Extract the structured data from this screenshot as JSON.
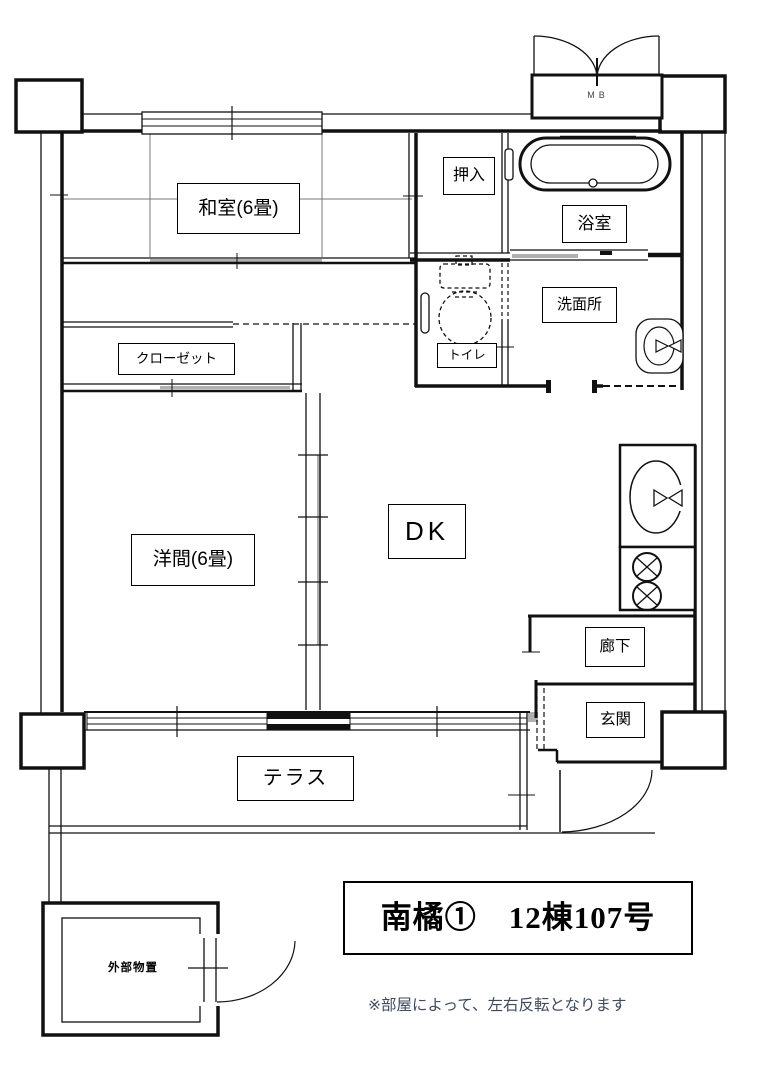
{
  "page": {
    "background": "#ffffff",
    "line_color": "#111111",
    "shade_color": "#b0b0b0"
  },
  "rooms": {
    "washitsu": "和室(6畳)",
    "oshiire": "押入",
    "bathroom": "浴室",
    "washroom": "洗面所",
    "toilet": "トイレ",
    "closet": "クローゼット",
    "western_room": "洋間(6畳)",
    "dk": "DK",
    "hallway": "廊下",
    "entrance": "玄関",
    "terrace": "テラス",
    "outdoor_storage": "外部物置",
    "meter_box": "MB"
  },
  "title_block": {
    "text": "南橘①　12棟107号"
  },
  "note": {
    "text": "※部屋によって、左右反転となります"
  }
}
